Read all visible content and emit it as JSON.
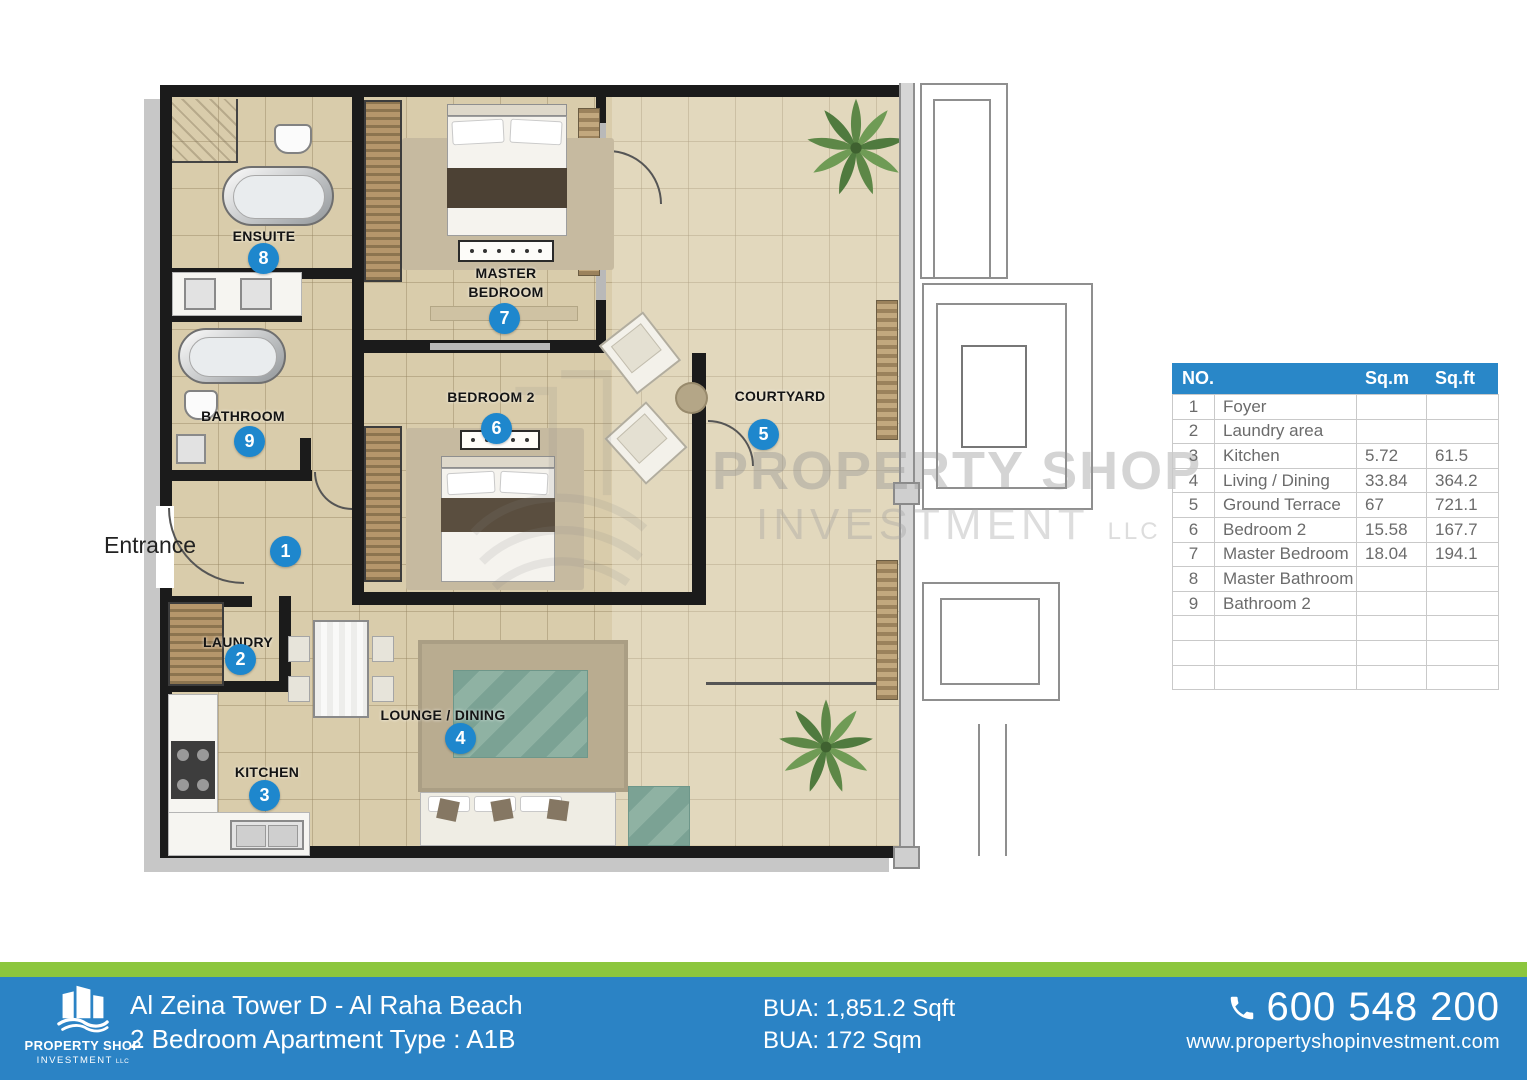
{
  "colors": {
    "brand_blue": "#2b83c5",
    "brand_green": "#8cc63e",
    "header_blue": "#2987c8",
    "marker_blue": "#1e87cd",
    "wall": "#1b1b1b",
    "floor": "#d9ccab"
  },
  "plan": {
    "entrance": "Entrance",
    "labels": {
      "ensuite": "ENSUITE",
      "master_line1": "MASTER",
      "master_line2": "BEDROOM",
      "bathroom": "BATHROOM",
      "bedroom2": "BEDROOM 2",
      "courtyard": "COURTYARD",
      "laundry": "LAUNDRY",
      "kitchen": "KITCHEN",
      "lounge": "LOUNGE / DINING"
    },
    "markers": {
      "foyer": "1",
      "laundry": "2",
      "kitchen": "3",
      "lounge": "4",
      "courtyard": "5",
      "bedroom2": "6",
      "master": "7",
      "ensuite": "8",
      "bathroom": "9"
    },
    "watermark": {
      "line1": "PROPERTY SHOP",
      "line2": "INVESTMENT",
      "suffix": "LLC"
    }
  },
  "area_table": {
    "headers": {
      "no": "NO.",
      "name": "",
      "sqm": "Sq.m",
      "sqft": "Sq.ft"
    },
    "rows": [
      {
        "no": "1",
        "name": "Foyer",
        "sqm": "",
        "sqft": ""
      },
      {
        "no": "2",
        "name": "Laundry area",
        "sqm": "",
        "sqft": ""
      },
      {
        "no": "3",
        "name": "Kitchen",
        "sqm": "5.72",
        "sqft": "61.5"
      },
      {
        "no": "4",
        "name": "Living / Dining",
        "sqm": "33.84",
        "sqft": "364.2"
      },
      {
        "no": "5",
        "name": "Ground Terrace",
        "sqm": "67",
        "sqft": "721.1"
      },
      {
        "no": "6",
        "name": "Bedroom 2",
        "sqm": "15.58",
        "sqft": "167.7"
      },
      {
        "no": "7",
        "name": "Master Bedroom",
        "sqm": "18.04",
        "sqft": "194.1"
      },
      {
        "no": "8",
        "name": "Master Bathroom",
        "sqm": "",
        "sqft": ""
      },
      {
        "no": "9",
        "name": "Bathroom 2",
        "sqm": "",
        "sqft": ""
      },
      {
        "no": "",
        "name": "",
        "sqm": "",
        "sqft": ""
      },
      {
        "no": "",
        "name": "",
        "sqm": "",
        "sqft": ""
      },
      {
        "no": "",
        "name": "",
        "sqm": "",
        "sqft": ""
      }
    ]
  },
  "footer": {
    "logo_line1": "PROPERTY SHOP",
    "logo_line2": "INVESTMENT",
    "logo_llc": "LLC",
    "title_line1": "Al Zeina Tower D - Al Raha Beach",
    "title_line2": "2 Bedroom Apartment Type : A1B",
    "bua_line1": "BUA: 1,851.2 Sqft",
    "bua_line2": "BUA: 172 Sqm",
    "phone": "600 548 200",
    "website": "www.propertyshopinvestment.com"
  }
}
